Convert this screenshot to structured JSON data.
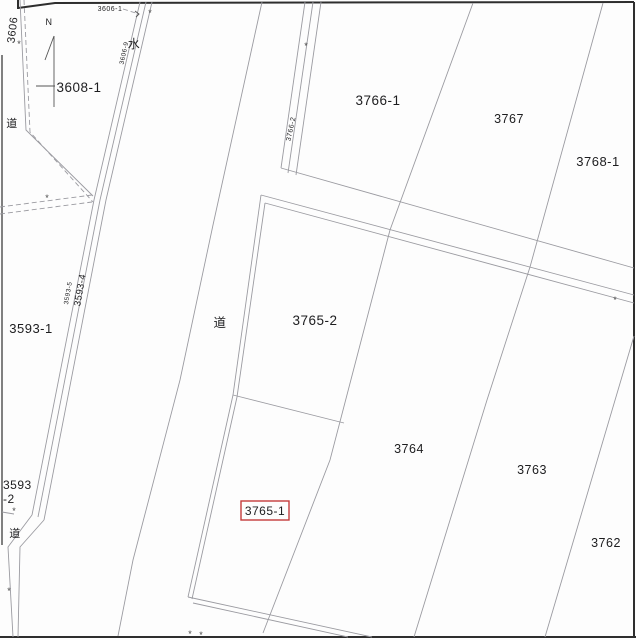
{
  "colors": {
    "background": "#fdfdfd",
    "frame": "#2e2e2e",
    "boundary": "#9b9ba1",
    "text": "#1d1d1f",
    "highlight": "#c43b3b"
  },
  "compass": {
    "north_label": "N"
  },
  "roads": {
    "main_label": "道",
    "northwest_label": "道",
    "southwest_label": "道"
  },
  "water": {
    "label": "水"
  },
  "parcels": {
    "p3606": "3606",
    "p3606_1": "3606-1",
    "p3606_9": "3606-9",
    "p3608_1": "3608-1",
    "p3593_1": "3593-1",
    "p3593_2_line1": "3593",
    "p3593_2_line2": "-2",
    "p3593_4": "3593-4",
    "p3593_5": "3593-5",
    "p3765_2": "3765-2",
    "p3765_1": "3765-1",
    "p3764": "3764",
    "p3763": "3763",
    "p3762": "3762",
    "p3766_1": "3766-1",
    "p3766_2": "3766-2",
    "p3767": "3767",
    "p3768_1": "3768-1"
  },
  "symbols": {
    "survey_mark": "*"
  }
}
